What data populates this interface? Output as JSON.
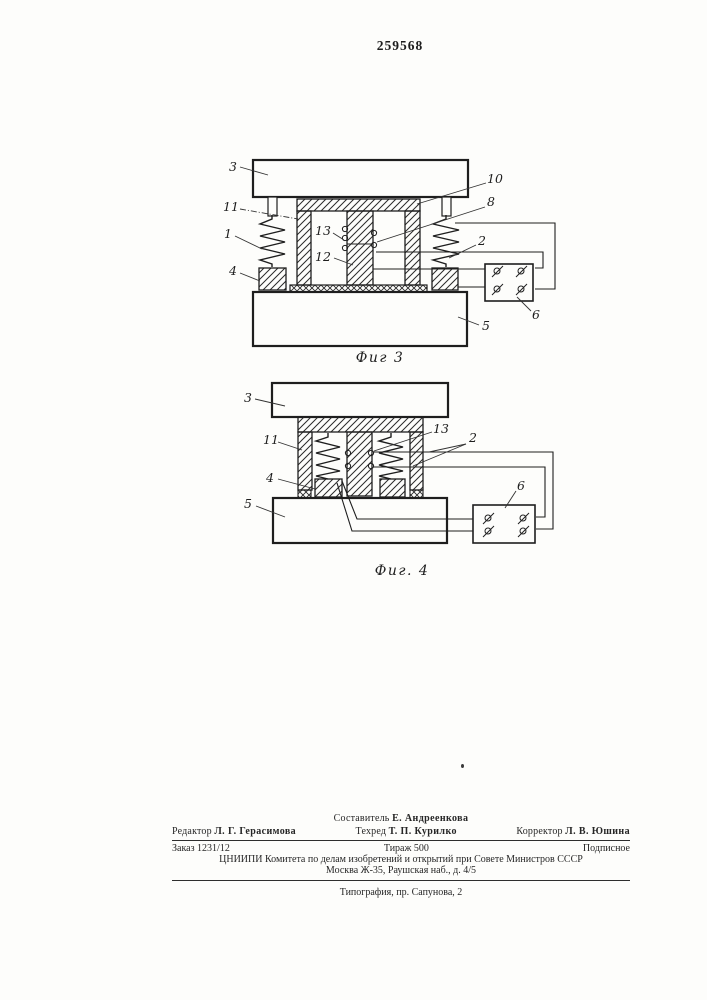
{
  "page": {
    "patent_number": "259568"
  },
  "figures": [
    {
      "caption": "Фиг 3",
      "labels": {
        "part3": "3",
        "part10": "10",
        "part11": "11",
        "part1": "1",
        "part13": "13",
        "part8": "8",
        "part12": "12",
        "part2": "2",
        "part4": "4",
        "part6": "6",
        "part5": "5"
      }
    },
    {
      "caption": "Фиг. 4",
      "labels": {
        "part3": "3",
        "part13": "13",
        "part11": "11",
        "part2": "2",
        "part4": "4",
        "part5": "5",
        "part6": "6"
      }
    }
  ],
  "colophon": {
    "compiler_role": "Составитель",
    "compiler_name": "Е. Андреенкова",
    "editor_role": "Редактор",
    "editor_name": "Л. Г. Герасимова",
    "tech_editor_role": "Техред",
    "tech_editor_name": "Т. П. Курилко",
    "proofreader_role": "Корректор",
    "proofreader_name": "Л. В. Юшина",
    "order": "Заказ 1231/12",
    "print_run": "Тираж 500",
    "subscription": "Подписное",
    "publisher_line1": "ЦНИИПИ Комитета по делам изобретений и открытий при Совете Министров СССР",
    "publisher_line2": "Москва Ж-35, Раушская наб., д. 4/5",
    "printer": "Типография, пр. Сапунова, 2"
  }
}
